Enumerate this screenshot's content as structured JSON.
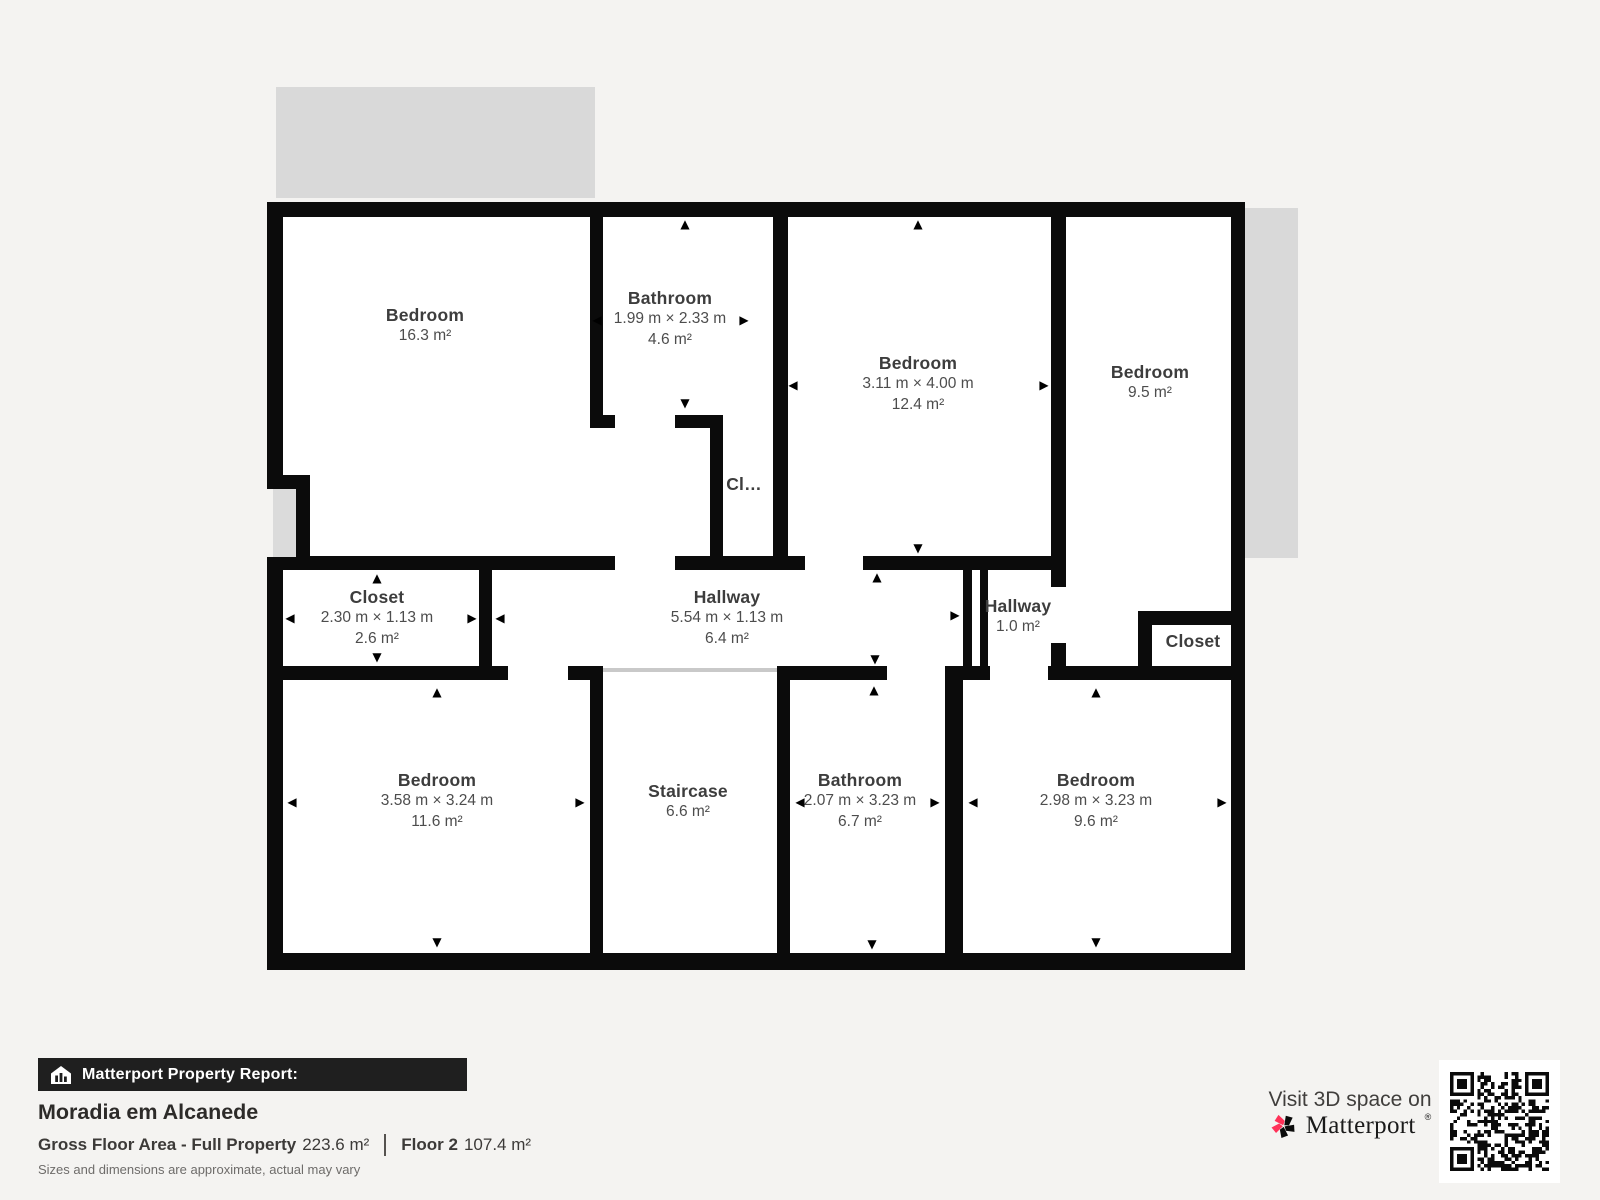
{
  "colors": {
    "page_bg": "#f4f3f1",
    "wall": "#0b0b0b",
    "room_fill": "#ffffff",
    "terrace": "#d9d9d9",
    "stair_edge": "#c9c9c9",
    "room_name": "#3d3d3d",
    "room_dims": "#4d4d4d",
    "bar_bg": "#1f1f1f",
    "bar_text": "#ffffff",
    "title": "#2d2b29",
    "body_text": "#3c3a38",
    "muted": "#6e6c6a",
    "brand_pink": "#ff3158",
    "brand_dark": "#1a1a1a"
  },
  "plan": {
    "icons": {
      "up": "▲",
      "down": "▼",
      "left": "◀",
      "right": "▶"
    },
    "rooms": [
      {
        "name": "Bedroom",
        "area": "16.3 m²"
      },
      {
        "name": "Bathroom",
        "dims": "1.99 m × 2.33 m",
        "area": "4.6 m²"
      },
      {
        "name": "Bedroom",
        "dims": "3.11 m × 4.00 m",
        "area": "12.4 m²"
      },
      {
        "name": "Bedroom",
        "area": "9.5 m²"
      },
      {
        "name": "Cl…"
      },
      {
        "name": "Closet",
        "dims": "2.30 m × 1.13 m",
        "area": "2.6 m²"
      },
      {
        "name": "Hallway",
        "dims": "5.54 m × 1.13 m",
        "area": "6.4 m²"
      },
      {
        "name": "Hallway",
        "area": "1.0 m²"
      },
      {
        "name": "Closet"
      },
      {
        "name": "Bedroom",
        "dims": "3.58 m × 3.24 m",
        "area": "11.6 m²"
      },
      {
        "name": "Staircase",
        "area": "6.6 m²"
      },
      {
        "name": "Bathroom",
        "dims": "2.07 m × 3.23 m",
        "area": "6.7 m²"
      },
      {
        "name": "Bedroom",
        "dims": "2.98 m × 3.23 m",
        "area": "9.6 m²"
      }
    ]
  },
  "footer": {
    "report_label": "Matterport Property Report:",
    "property_name": "Moradia em Alcanede",
    "gross_label": "Gross Floor Area - Full Property",
    "gross_value": "223.6 m²",
    "floor_label": "Floor 2",
    "floor_value": "107.4 m²",
    "disclaimer": "Sizes and dimensions are approximate, actual may vary",
    "visit_text": "Visit 3D space on",
    "brand": "Matterport",
    "brand_mark": "®"
  }
}
